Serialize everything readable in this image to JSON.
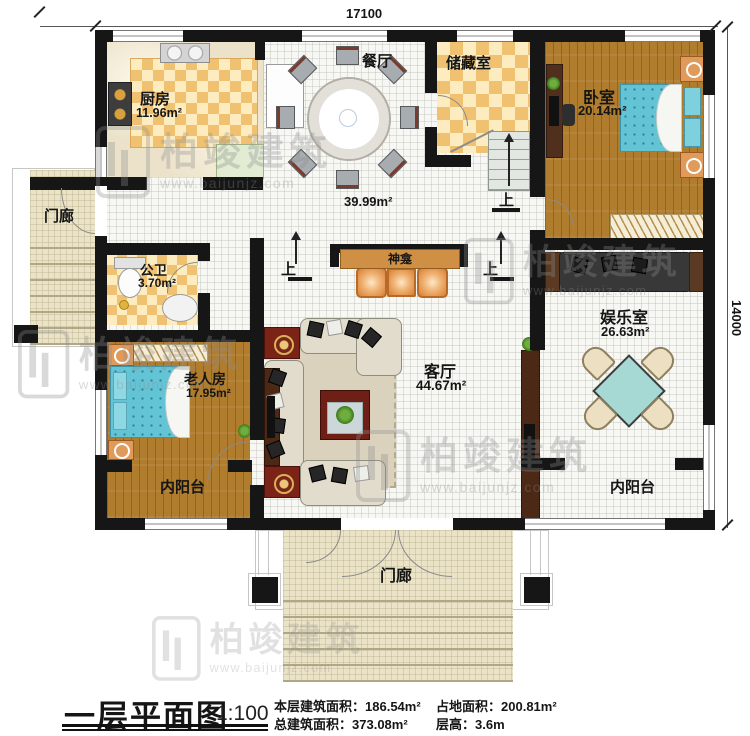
{
  "dimensions": {
    "top": "17100",
    "right": "14000"
  },
  "rooms": {
    "kitchen": {
      "label": "厨房",
      "area": "11.96m²"
    },
    "dining": {
      "label": "餐厅",
      "area": "39.99m²"
    },
    "storage": {
      "label": "储藏室"
    },
    "bedroom": {
      "label": "卧室",
      "area": "20.14m²"
    },
    "porch_left": {
      "label": "门廊"
    },
    "bathroom": {
      "label": "公卫",
      "area": "3.70m²"
    },
    "elder_room": {
      "label": "老人房",
      "area": "17.95m²"
    },
    "living": {
      "label": "客厅",
      "area": "44.67m²"
    },
    "shrine": {
      "label": "神龛"
    },
    "entertainment": {
      "label": "娱乐室",
      "area": "26.63m²"
    },
    "balcony_left": {
      "label": "内阳台"
    },
    "balcony_right": {
      "label": "内阳台"
    },
    "porch_bottom": {
      "label": "门廊"
    }
  },
  "stairs": {
    "up1": "上",
    "up2": "上",
    "up3": "上"
  },
  "title_block": {
    "title": "一层平面图",
    "scale": "1:100",
    "stats": [
      {
        "label": "本层建筑面积：",
        "value": "186.54m²"
      },
      {
        "label": "占地面积：",
        "value": "200.81m²"
      },
      {
        "label": "总建筑面积：",
        "value": "373.08m²"
      },
      {
        "label": "层高：",
        "value": "3.6m"
      }
    ]
  },
  "watermark": {
    "brand": "柏竣建筑",
    "website": "www.baijunjz.com"
  },
  "colors": {
    "wall": "#161616",
    "wood": "#b07c2e",
    "checker": "#f0c170",
    "bed": "#63c4d6",
    "shrine": "#cf8f44"
  }
}
